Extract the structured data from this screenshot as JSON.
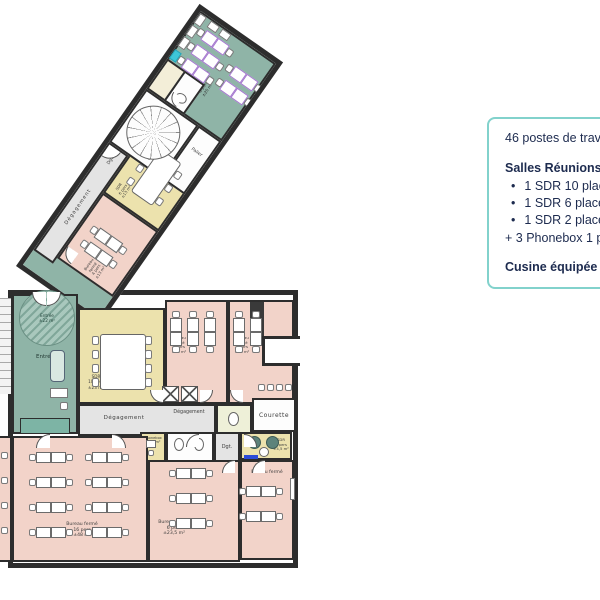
{
  "panel": {
    "headline": "46 postes de travail",
    "meeting_title": "Salles Réunions :",
    "meeting_items": [
      "1 SDR 10 places",
      "1 SDR 6 places",
      "1 SDR 2 places"
    ],
    "phonebox_note": "+ 3 Phonebox 1 place",
    "kitchen_note": "Cusine équipée"
  },
  "plan": {
    "wing": {
      "corridor": "Dégagement",
      "dgt": "Dgt.",
      "office4": "Bureau fermé\n4 pers\n±13 m²",
      "sdr6": "SDR\n6 pers\n±13 m²",
      "palier": "Palier",
      "open_office": "Bureau partagé\n8 pers\n±25 m²"
    },
    "main": {
      "entree_zone": "Entrée\n±22 m²",
      "entree": "Entrée",
      "sdr10": "SDR\n10 pers\n±23 m²",
      "degagement1": "Dégagement",
      "degagement2": "Dégagement",
      "office_a": "Bureau fermé\n6 pers\n±16 m²",
      "office_b": "Bureau fermé\n4 pers\n±14 m²",
      "courette": "Courette",
      "phonebox": "Phonebox\n±1,5 m²",
      "dgt": "Dgt.",
      "sdr2": "SDR\n2 pers\n±4,5 m²",
      "office16": "Bureau fermé\n16 pers\n±48 m²",
      "office6": "Bureau fermé\n6 pers\n±23,5 m²",
      "office4b": "Bureau fermé"
    }
  },
  "colors": {
    "accent_border": "#82d2cc",
    "text": "#1d2b4f",
    "teal_room": "#8fb4a7",
    "yellow_room": "#ece2ad",
    "pink_room": "#f2d3c9",
    "wall": "#2d2d2d",
    "purple_desk": "#a577cf",
    "sink_cyan": "#3ec6d8"
  }
}
